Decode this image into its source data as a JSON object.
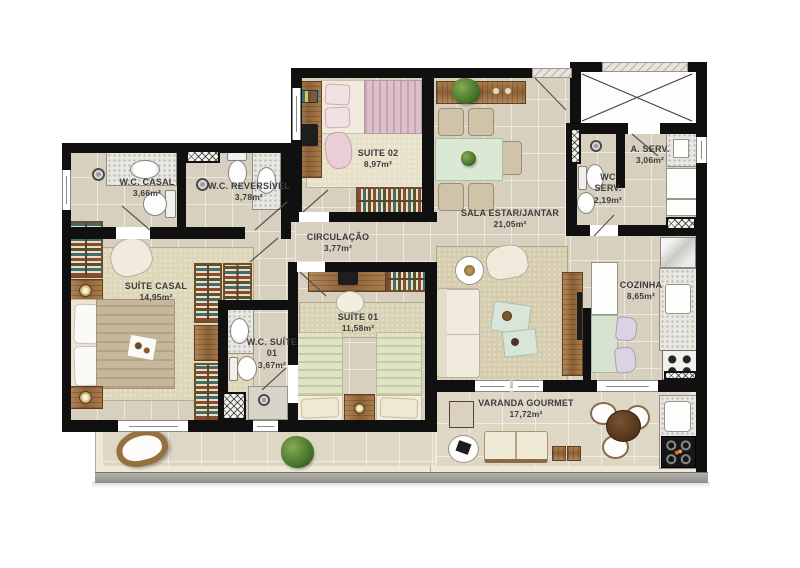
{
  "document": {
    "type": "apartment-floor-plan"
  },
  "rooms": [
    {
      "id": "wc-casal",
      "name": "W.C. CASAL",
      "area": "3,66m²"
    },
    {
      "id": "wc-reversivel",
      "name": "W.C. REVERSÍVEL",
      "area": "3,78m²"
    },
    {
      "id": "suite-02",
      "name": "SUITE 02",
      "area": "8,97m²"
    },
    {
      "id": "sala",
      "name": "SALA ESTAR/JANTAR",
      "area": "21,05m²"
    },
    {
      "id": "a-serv",
      "name": "A. SERV.",
      "area": "3,06m²"
    },
    {
      "id": "wc-serv",
      "name": "WC SERV.",
      "area": "2,19m²"
    },
    {
      "id": "circulacao",
      "name": "CIRCULAÇÃO",
      "area": "3,77m²"
    },
    {
      "id": "suite-casal",
      "name": "SUÍTE CASAL",
      "area": "14,95m²"
    },
    {
      "id": "suite-01",
      "name": "SUÍTE 01",
      "area": "11,58m²"
    },
    {
      "id": "wc-suite-01",
      "name": "W.C. SUÍTE 01",
      "area": "3,67m²"
    },
    {
      "id": "cozinha",
      "name": "COZINHA",
      "area": "8,65m²"
    },
    {
      "id": "varanda",
      "name": "VARANDA GOURMET",
      "area": "17,72m²"
    }
  ],
  "colors": {
    "wall": "#101010",
    "floor": "#d8d0bf",
    "varanda_floor": "#ded7c5",
    "varanda_band": "#eee8d6",
    "label_text": "#3c3c3c",
    "wood": "#a87c4e",
    "granite": "#e9e7e2",
    "bed_pink": "#dcc0ca",
    "bed_green": "#e0e4c4",
    "bed_taupe": "#c6b69a",
    "glass_table": "#dce8d6",
    "sofa": "#f0ebdd",
    "plant": "#4d7a2c",
    "parapet": "#a9a7a1"
  },
  "icons": {
    "shower": "shower-icon",
    "lamp": "lamp-icon",
    "plant": "plant-icon",
    "shaft": "x-cross-shaft-icon",
    "duct": "crosshatch-duct-icon",
    "stove": "stove-burners-icon",
    "grill": "grill-icon"
  }
}
